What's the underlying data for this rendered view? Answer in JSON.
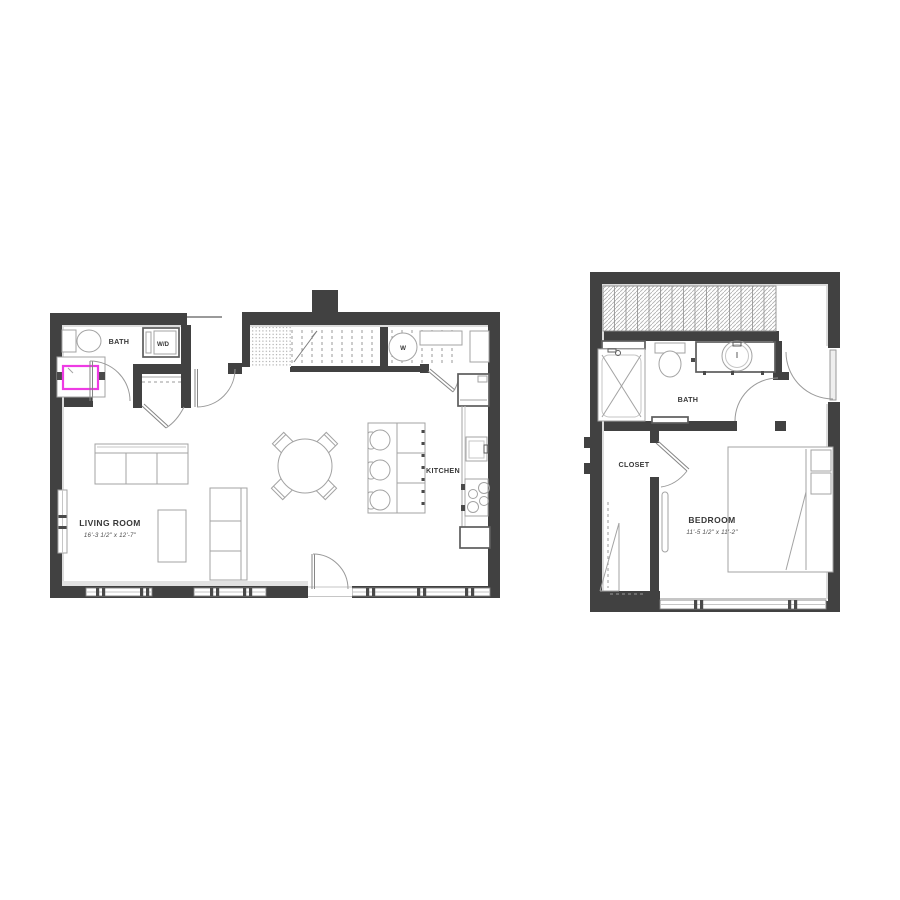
{
  "colors": {
    "wall": "#414141",
    "outline": "#a3a3a3",
    "outline_dark": "#5c5c5c",
    "highlight_pink": "#ee3be4"
  },
  "unit_a": {
    "bath_label": "BATH",
    "washer_dryer_label": "W/D",
    "washer_letter": "W",
    "kitchen_label": "KITCHEN",
    "living_room_label": "LIVING ROOM",
    "living_room_dimensions": "16'-3 1/2\" x 12'-7\""
  },
  "unit_b": {
    "bath_label": "BATH",
    "closet_label": "CLOSET",
    "bedroom_label": "BEDROOM",
    "bedroom_dimensions": "11'-5 1/2\" x 11'-2\""
  }
}
